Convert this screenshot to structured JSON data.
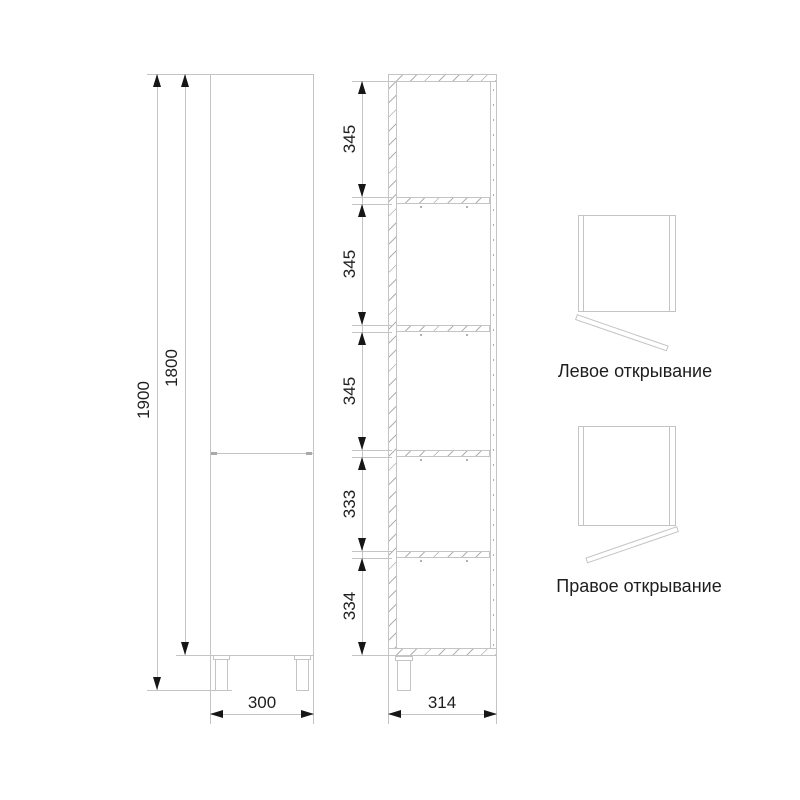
{
  "dimensions": {
    "front": {
      "total_height": "1900",
      "body_height": "1800",
      "width": "300"
    },
    "section": {
      "depth": "314",
      "segments": [
        "345",
        "345",
        "345",
        "333",
        "334"
      ]
    }
  },
  "door_opening": {
    "left_label": "Левое открывание",
    "right_label": "Правое открывание"
  },
  "colors": {
    "line": "#c4c4c4",
    "hatch": "#b0b0b0",
    "arrow": "#161616",
    "text": "#1e1e1e",
    "background": "#ffffff"
  }
}
